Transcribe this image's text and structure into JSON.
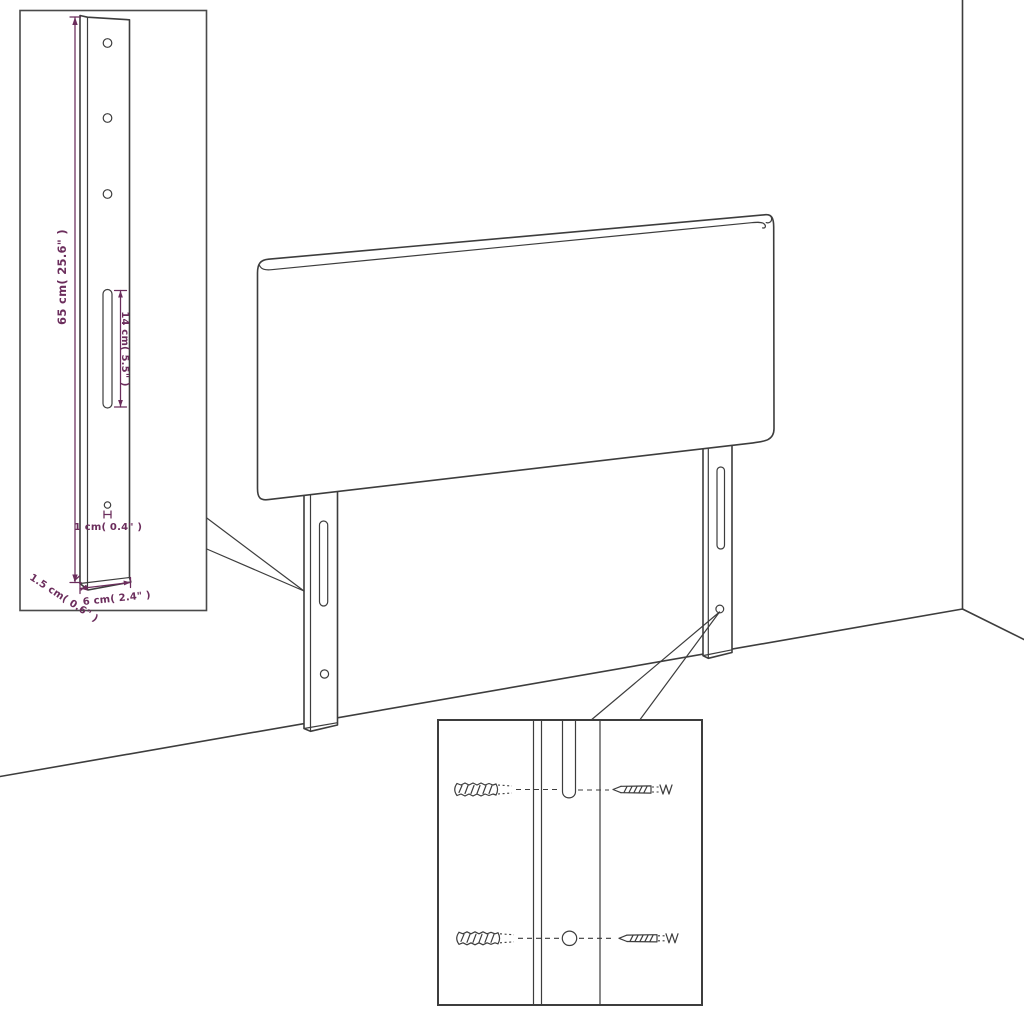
{
  "colors": {
    "background": "#ffffff",
    "line_art": "#3d3d3d",
    "dimension_text": "#6b2d5c"
  },
  "inset_dimensions": {
    "total_height": "65 cm( 25.6\" )",
    "slot_length": "14 cm( 5.5\" )",
    "hole_diameter": "1 cm( 0.4\" )",
    "bottom_thickness": "1.5 cm( 0.6\" )",
    "leg_width": "6 cm( 2.4\" )"
  },
  "icons": {
    "wall_plug": "wall-plug-icon",
    "screw": "screw-icon"
  }
}
